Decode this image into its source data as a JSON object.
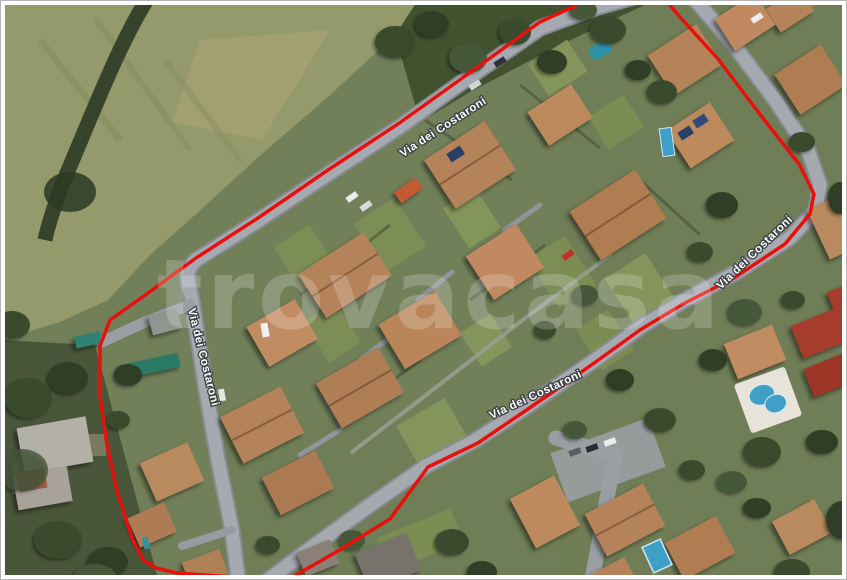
{
  "page": {
    "title": "Aerial satellite view of residential neighborhood with red property boundary"
  },
  "street_labels": [
    {
      "text": "Via dei Costaroni"
    },
    {
      "text": "Via dei Costaroni"
    },
    {
      "text": "Via dei Costaroni"
    },
    {
      "text": "Via dei Costaroni"
    }
  ],
  "watermark": {
    "text": "trovacasa"
  },
  "colors": {
    "boundary": "#e8100d",
    "road": "#a6aab0",
    "road_edge": "#878c92",
    "field": "#959a6c",
    "roof_terracotta": "#b5835a",
    "roof_red": "#a63c2c",
    "tree_dark": "#3a4b2d",
    "pool_blue": "#3f9fc6",
    "label_fill": "#ffffff",
    "label_outline": "#3c4043",
    "frame": "#ffffff"
  }
}
